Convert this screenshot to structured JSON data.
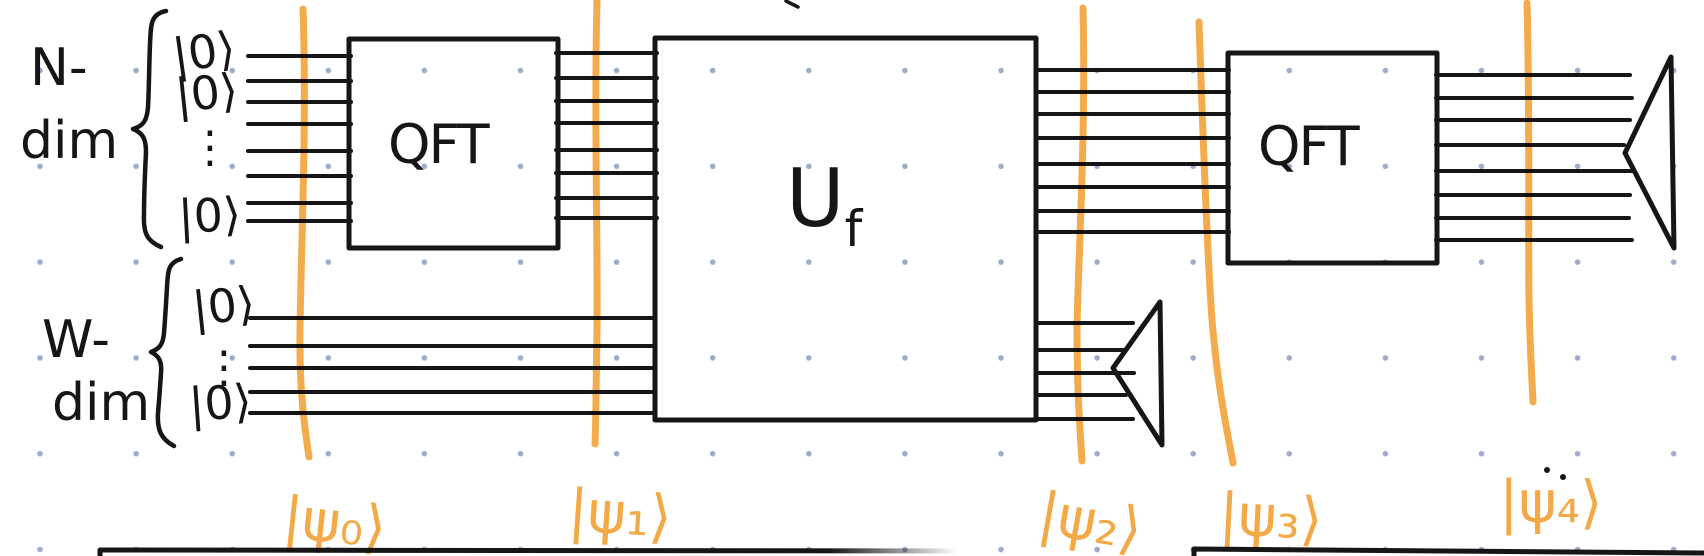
{
  "canvas": {
    "background_color": "#ffffff",
    "grid_dot_color": "#9fabcd",
    "ink_color": "#161616",
    "marker_color": "#f3a43b"
  },
  "registers": {
    "n": {
      "label_line1": "N-",
      "label_line2": "dim",
      "kets": [
        "|0⟩",
        "|0⟩",
        "⋮",
        "|0⟩"
      ],
      "wire_count": 8
    },
    "w": {
      "label_line1": "W-",
      "label_line2": "dim",
      "kets": [
        "|0⟩",
        "⋮",
        "|0⟩"
      ],
      "wire_count": 5
    }
  },
  "gates": {
    "qft1": {
      "label": "QFT"
    },
    "uf": {
      "label_main": "U",
      "label_sub": "f"
    },
    "qft2": {
      "label": "QFT"
    }
  },
  "state_markers": [
    {
      "label": "|ψ₀⟩"
    },
    {
      "label": "|ψ₁⟩"
    },
    {
      "label": "|ψ₂⟩"
    },
    {
      "label": "|ψ₃⟩"
    },
    {
      "label": "|ψ₄⟩"
    }
  ]
}
